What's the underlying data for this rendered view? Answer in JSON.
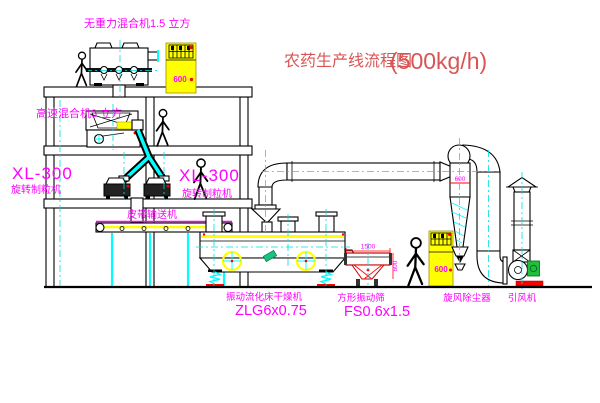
{
  "title": {
    "name": "农药生产线流程图",
    "capacity": "(500kg/h)"
  },
  "equipment_labels": {
    "gravity_mixer": "无重力混合机1.5 立方",
    "high_speed_mixer": "高速混合机3 立方",
    "granulator_left": {
      "model": "XL-300",
      "name": "旋转制粒机"
    },
    "granulator_right": {
      "model": "XL-300",
      "name": "旋转制粒机"
    },
    "belt_conveyor": "皮带输送机",
    "fluid_bed_dryer": {
      "name": "振动流化床干燥机",
      "model": "ZLG6x0.75"
    },
    "vibrating_screen": {
      "name": "方形振动筛",
      "model": "FS0.6x1.5"
    },
    "cyclone": "旋风除尘器",
    "induced_fan": "引风机"
  },
  "dimensions": {
    "cyclone_dia": "600",
    "screen_width": "1500",
    "screen_height": "600",
    "cabinet1_panel": "600",
    "cabinet2_panel": "600"
  },
  "colors": {
    "label_magenta": "#ff00ff",
    "title_red": "#d85555",
    "centerline_cyan": "#00dede",
    "solid_cyan": "#00ffff",
    "cad_yellow": "#ffff00",
    "cad_red": "#ff0000",
    "motor_green": "#1fbe3c"
  }
}
